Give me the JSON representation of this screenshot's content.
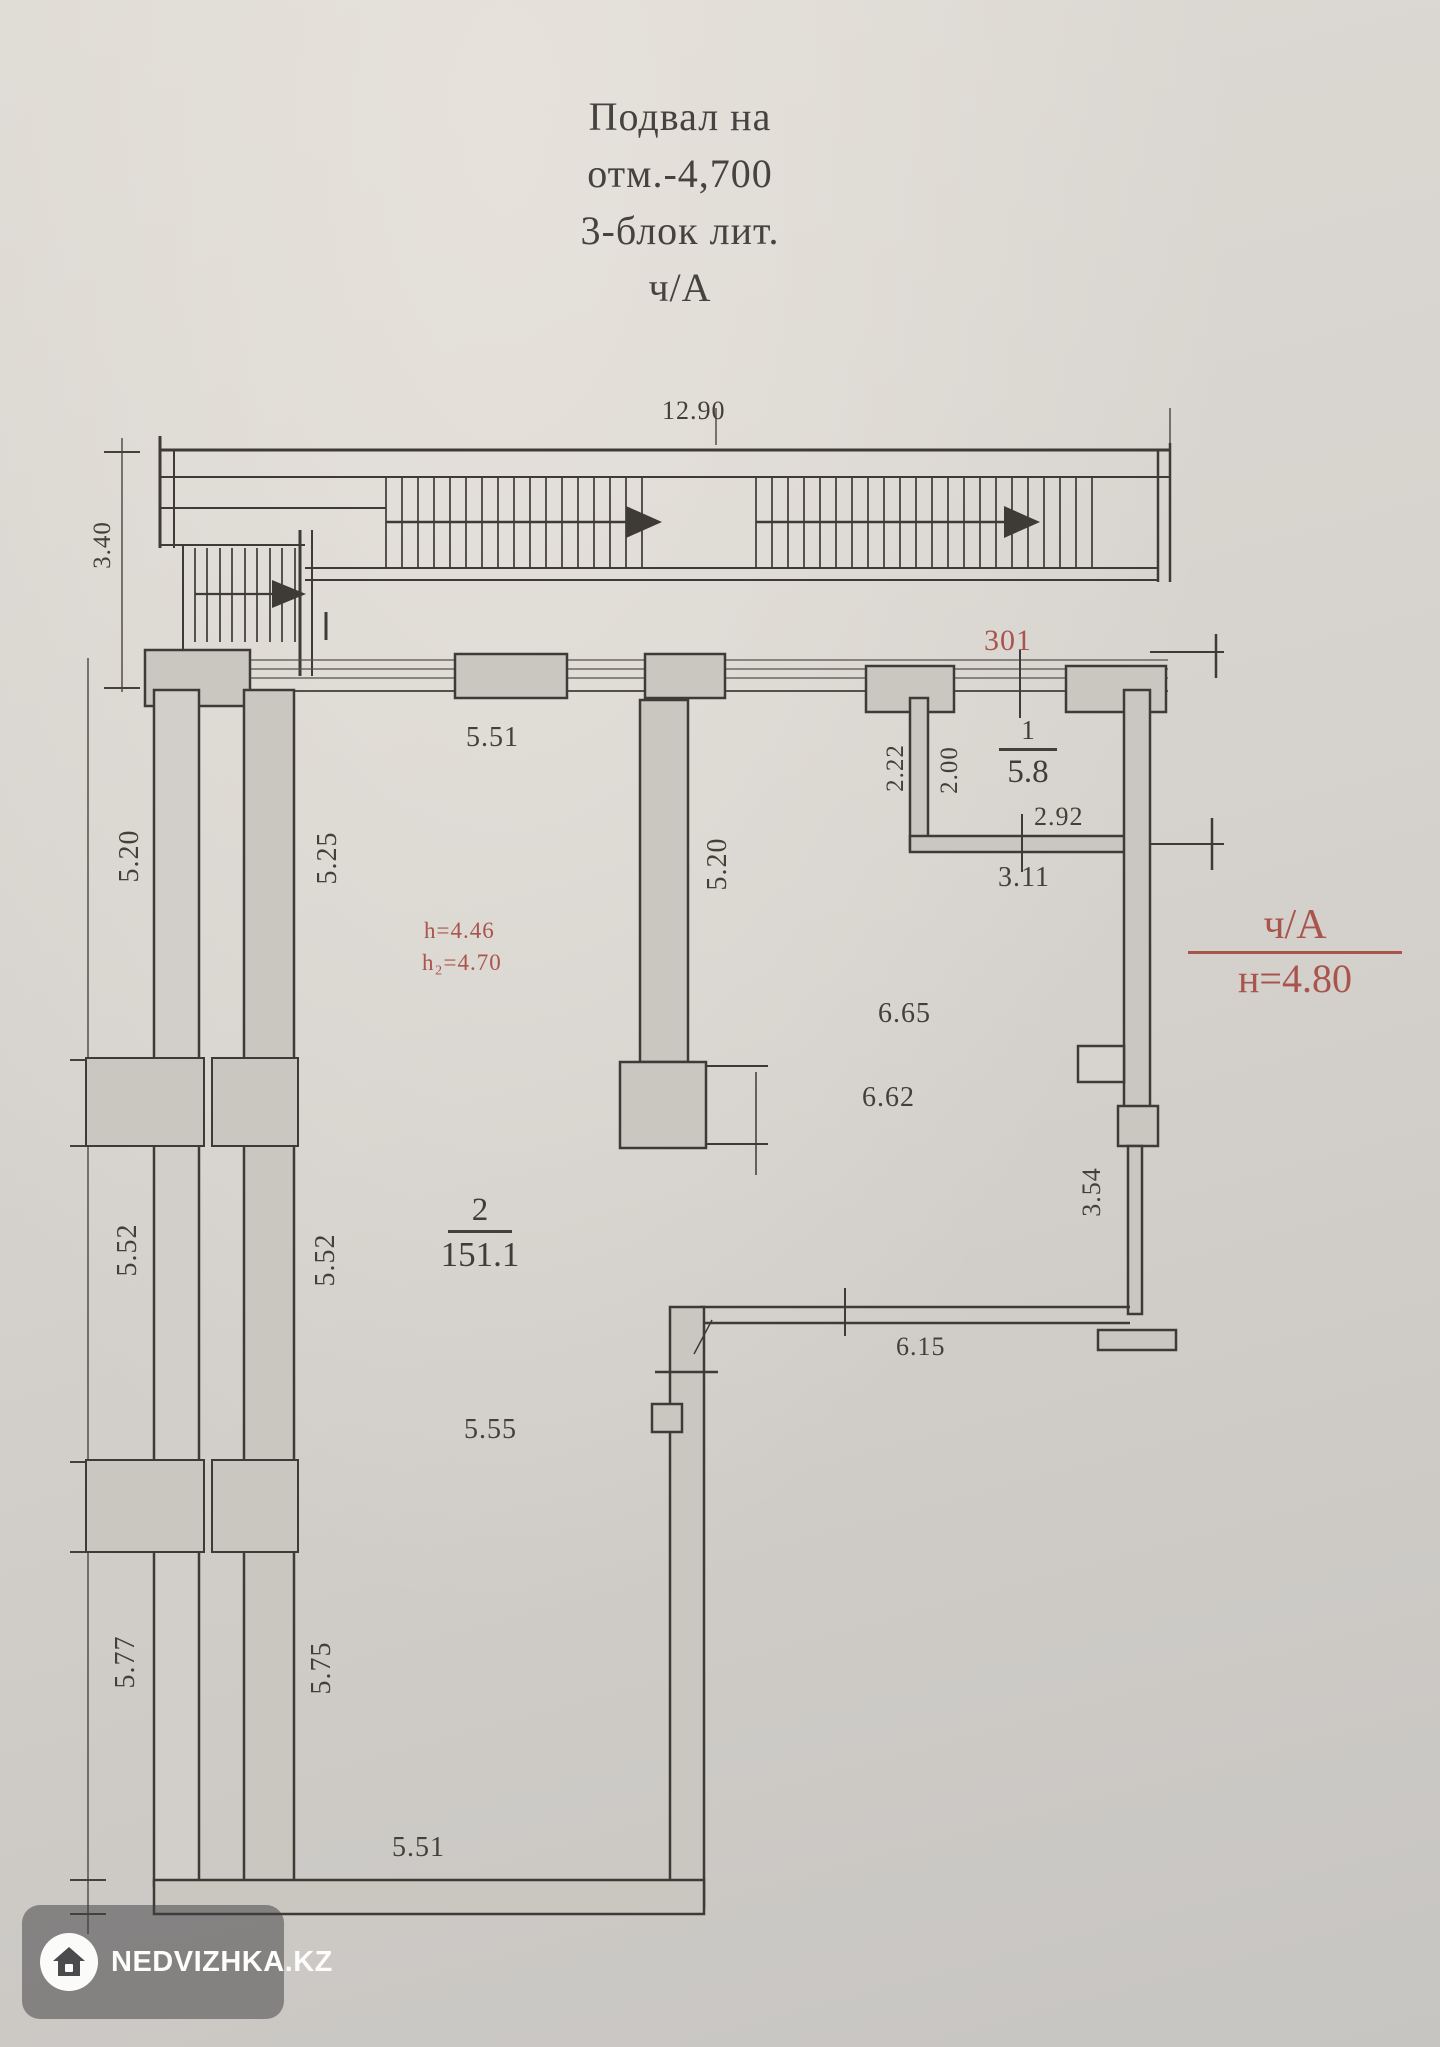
{
  "title": {
    "lines": [
      "Подвал на",
      "отм.-4,700",
      "3-блок лит.",
      "ч/А"
    ]
  },
  "plan": {
    "rooms": [
      {
        "number": "1",
        "area": "5.8"
      },
      {
        "number": "2",
        "area": "151.1"
      }
    ],
    "red_annotations": {
      "room_id": "301",
      "section_mark": "ч/А",
      "section_height": "н=4.80",
      "height_note_1": "h=4.46",
      "height_note_2": "h₂=4.70"
    },
    "dimensions": {
      "top_width": "12.90",
      "left_stair_height": "3.40",
      "room2_top_width": "5.51",
      "col_left_1": "5.20",
      "col_inner_1": "5.25",
      "col_mid_1": "5.20",
      "room1_left_height": "2.22",
      "room1_inner_height": "2.00",
      "room1_width": "2.92",
      "room1_width_outer": "3.11",
      "hall_width_1": "6.65",
      "hall_width_2": "6.62",
      "col_left_2": "5.52",
      "col_inner_2": "5.52",
      "right_wall_height": "3.54",
      "hall_bottom_width": "6.15",
      "room2_mid_width": "5.55",
      "col_left_3": "5.77",
      "col_inner_3": "5.75",
      "bottom_width": "5.51"
    }
  },
  "watermark": {
    "text": "NEDVIZHKA.KZ"
  },
  "colors": {
    "annotation_red": "#a9544d",
    "ink": "#3e3b37",
    "paper": "#d7d3ce",
    "wall_fill": "#cac7c1"
  }
}
